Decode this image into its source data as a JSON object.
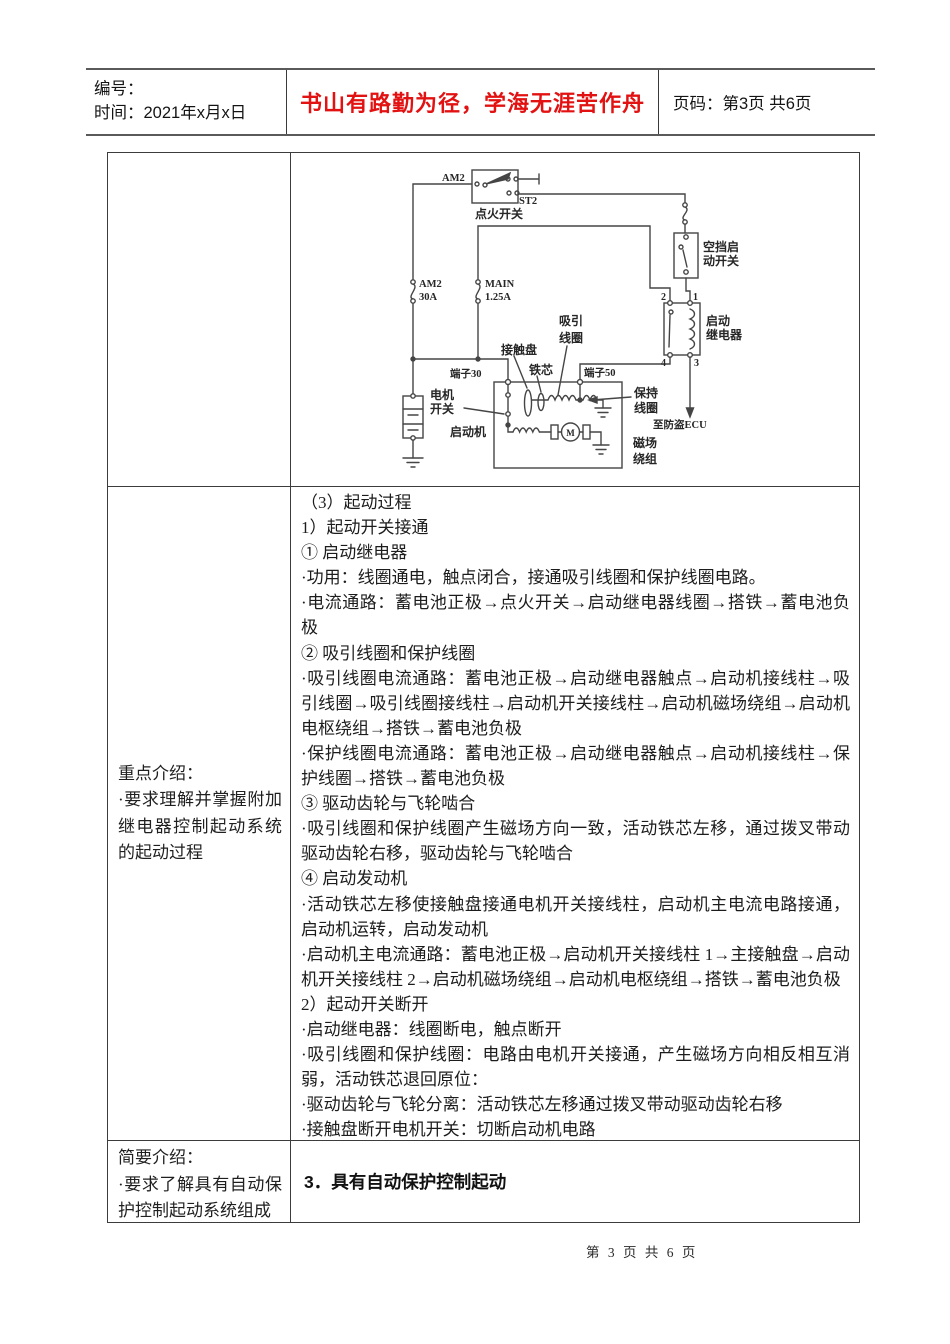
{
  "header": {
    "number_label": "编号：",
    "time_label": "时间：2021年x月x日",
    "motto": "书山有路勤为径，学海无涯苦作舟",
    "page_label": "页码：第3页 共6页"
  },
  "colors": {
    "motto_red": "#e31212",
    "ink": "#1f1f1f",
    "border": "#3c3c3c"
  },
  "table": {
    "row2_left": {
      "title": "重点介绍：",
      "body": "·要求理解并掌握附加继电器控制起动系统的起动过程"
    },
    "row3_left": {
      "title": "简要介绍：",
      "body": "·要求了解具有自动保护控制起动系统组成"
    },
    "row3_right_heading": "3．具有自动保护控制起动",
    "row2_right_lines": [
      "（3）起动过程",
      "1）起动开关接通",
      "① 启动继电器",
      "·功用：线圈通电，触点闭合，接通吸引线圈和保护线圈电路。",
      "·电流通路：蓄电池正极→点火开关→启动继电器线圈→搭铁→蓄电池负极",
      "② 吸引线圈和保护线圈",
      "·吸引线圈电流通路：蓄电池正极→启动继电器触点→启动机接线柱→吸引线圈→吸引线圈接线柱→启动机开关接线柱→启动机磁场绕组→启动机电枢绕组→搭铁→蓄电池负极",
      "·保护线圈电流通路：蓄电池正极→启动继电器触点→启动机接线柱→保护线圈→搭铁→蓄电池负极",
      "③ 驱动齿轮与飞轮啮合",
      "·吸引线圈和保护线圈产生磁场方向一致，活动铁芯左移，通过拨叉带动驱动齿轮右移，驱动齿轮与飞轮啮合",
      "④ 启动发动机",
      "·活动铁芯左移使接触盘接通电机开关接线柱，启动机主电流电路接通，启动机运转，启动发动机",
      "·启动机主电流通路：蓄电池正极→启动机开关接线柱 1→主接触盘→启动机开关接线柱 2→启动机磁场绕组→启动机电枢绕组→搭铁→蓄电池负极",
      "2）起动开关断开",
      "·启动继电器：线圈断电，触点断开",
      "·吸引线圈和保护线圈：电路由电机开关接通，产生磁场方向相反相互消弱，活动铁芯退回原位：",
      "·驱动齿轮与飞轮分离：活动铁芯左移通过拨叉带动驱动齿轮右移",
      "·接触盘断开电机开关：切断启动机电路"
    ]
  },
  "diagram": {
    "am2_terminal": "AM2",
    "st2_terminal": "ST2",
    "ignition_switch": "点火开关",
    "fuse_am2_name": "AM2",
    "fuse_am2_rating": "30A",
    "fuse_main_name": "MAIN",
    "fuse_main_rating": "1.25A",
    "neutral_switch_l1": "空挡启",
    "neutral_switch_l2": "动开关",
    "relay_l1": "启动",
    "relay_l2": "继电器",
    "relay_t2": "2",
    "relay_t1": "1",
    "relay_t4": "4",
    "relay_t3": "3",
    "terminal_30": "端子30",
    "terminal_50": "端子50",
    "contact_disc": "接触盘",
    "iron_core": "铁芯",
    "pull_coil_l1": "吸引",
    "pull_coil_l2": "线圈",
    "hold_coil_l1": "保持",
    "hold_coil_l2": "线圈",
    "motor_switch_l1": "电机",
    "motor_switch_l2": "开关",
    "starter": "启动机",
    "to_ecu": "至防盗ECU",
    "field_winding_l1": "磁场",
    "field_winding_l2": "绕组",
    "motor_m": "M"
  },
  "footer": {
    "page_text": "第 3 页 共 6 页"
  }
}
